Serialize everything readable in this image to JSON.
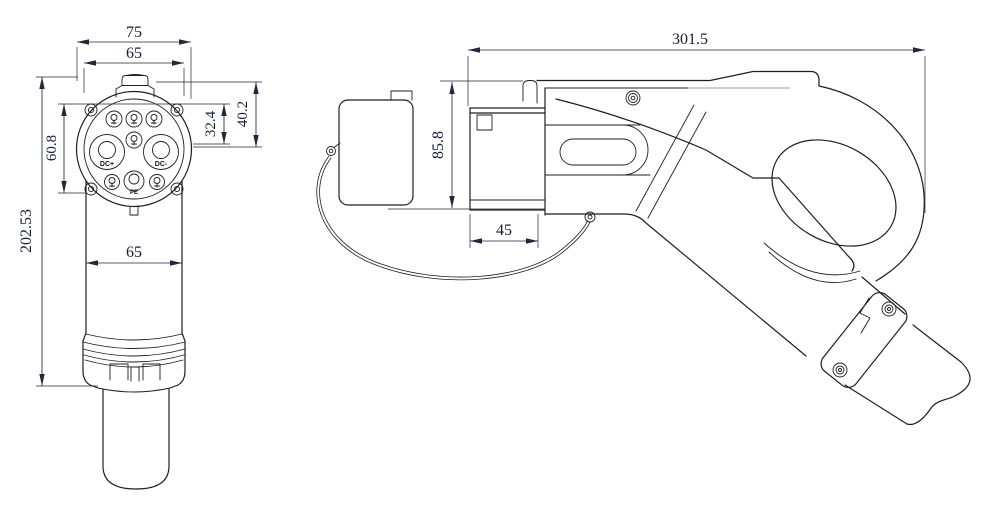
{
  "drawing": {
    "type": "technical-drawing",
    "subject": "EV charging connector (DC gun) - front and side orthographic views",
    "line_color": "#1f1f1f",
    "dimension_color": "#151d3a",
    "front_view": {
      "pin_labels": {
        "dc_plus": "DC+",
        "dc_minus": "DC-",
        "pe": "PE"
      },
      "dimensions": {
        "flange_width": "75",
        "face_width": "65",
        "screw_span": "60.8",
        "overall_height": "202.53",
        "pin_height": "32.4",
        "face_height": "40.2",
        "body_width": "65"
      }
    },
    "side_view": {
      "dimensions": {
        "overall_length": "301.5",
        "body_height": "85.8",
        "coupler_depth": "45"
      }
    }
  }
}
